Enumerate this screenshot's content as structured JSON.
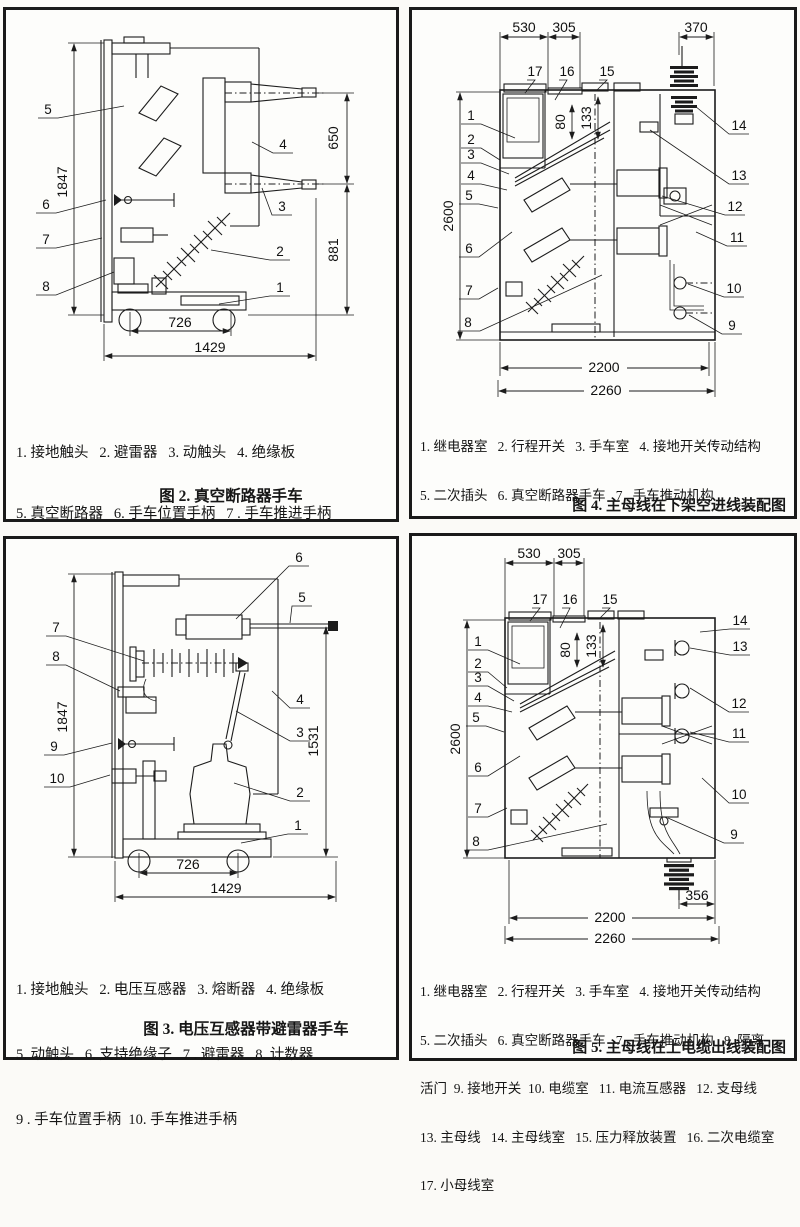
{
  "fig2": {
    "caption": "图 2. 真空断路器手车",
    "legend_lines": [
      "1. 接地触头   2. 避雷器   3. 动触头   4. 绝缘板",
      "5. 真空断路器   6. 手车位置手柄   7 . 手车推进手柄",
      "8. 计数器"
    ],
    "dims": {
      "height": "1847",
      "upper": "650",
      "lower": "881",
      "inner": "726",
      "overall": "1429"
    },
    "callouts": [
      "1",
      "2",
      "3",
      "4",
      "5",
      "6",
      "7",
      "8"
    ]
  },
  "fig3": {
    "caption": "图 3. 电压互感器带避雷器手车",
    "legend_lines": [
      "1. 接地触头   2. 电压互感器   3. 熔断器   4. 绝缘板",
      "5. 动触头   6. 支持绝缘子   7 . 避雷器   8. 计数器",
      "9 . 手车位置手柄  10. 手车推进手柄"
    ],
    "dims": {
      "height": "1847",
      "right": "1531",
      "inner": "726",
      "overall": "1429"
    },
    "callouts": [
      "1",
      "2",
      "3",
      "4",
      "5",
      "6",
      "7",
      "8",
      "9",
      "10"
    ]
  },
  "fig4": {
    "caption": "图 4. 主母线在下架空进线装配图",
    "legend_lines": [
      "1. 继电器室   2. 行程开关   3. 手车室   4. 接地开关传动结构",
      "5. 二次插头   6. 真空断路器手车   7 . 手车推动机构",
      "8. 隔离活门  9. 支母线  10. 主母线   11. 母线室   12. 电流",
      "互感器   13. 接地开关   14. 进出线室   15. 压力释放装置",
      "16. 二次电缆室   17. 小母线室"
    ],
    "dims": {
      "a": "530",
      "b": "305",
      "c": "370",
      "height": "2600",
      "e": "80",
      "f": "133",
      "inner": "2200",
      "overall": "2260"
    },
    "callouts": [
      "1",
      "2",
      "3",
      "4",
      "5",
      "6",
      "7",
      "8",
      "9",
      "10",
      "11",
      "12",
      "13",
      "14",
      "15",
      "16",
      "17"
    ]
  },
  "fig5": {
    "caption": "图 5. 主母线在上电缆出线装配图",
    "legend_lines": [
      "1. 继电器室   2. 行程开关   3. 手车室   4. 接地开关传动结构",
      "5. 二次插头   6. 真空断路器手车   7 . 手车推动机构   8. 隔离",
      "活门  9. 接地开关  10. 电缆室   11. 电流互感器   12. 支母线",
      "13. 主母线   14. 主母线室   15. 压力释放装置   16. 二次电缆室",
      "17. 小母线室"
    ],
    "dims": {
      "a": "530",
      "b": "305",
      "cable": "356",
      "height": "2600",
      "e": "80",
      "f": "133",
      "inner": "2200",
      "overall": "2260"
    },
    "callouts": [
      "1",
      "2",
      "3",
      "4",
      "5",
      "6",
      "7",
      "8",
      "9",
      "10",
      "11",
      "12",
      "13",
      "14",
      "15",
      "16",
      "17"
    ]
  }
}
